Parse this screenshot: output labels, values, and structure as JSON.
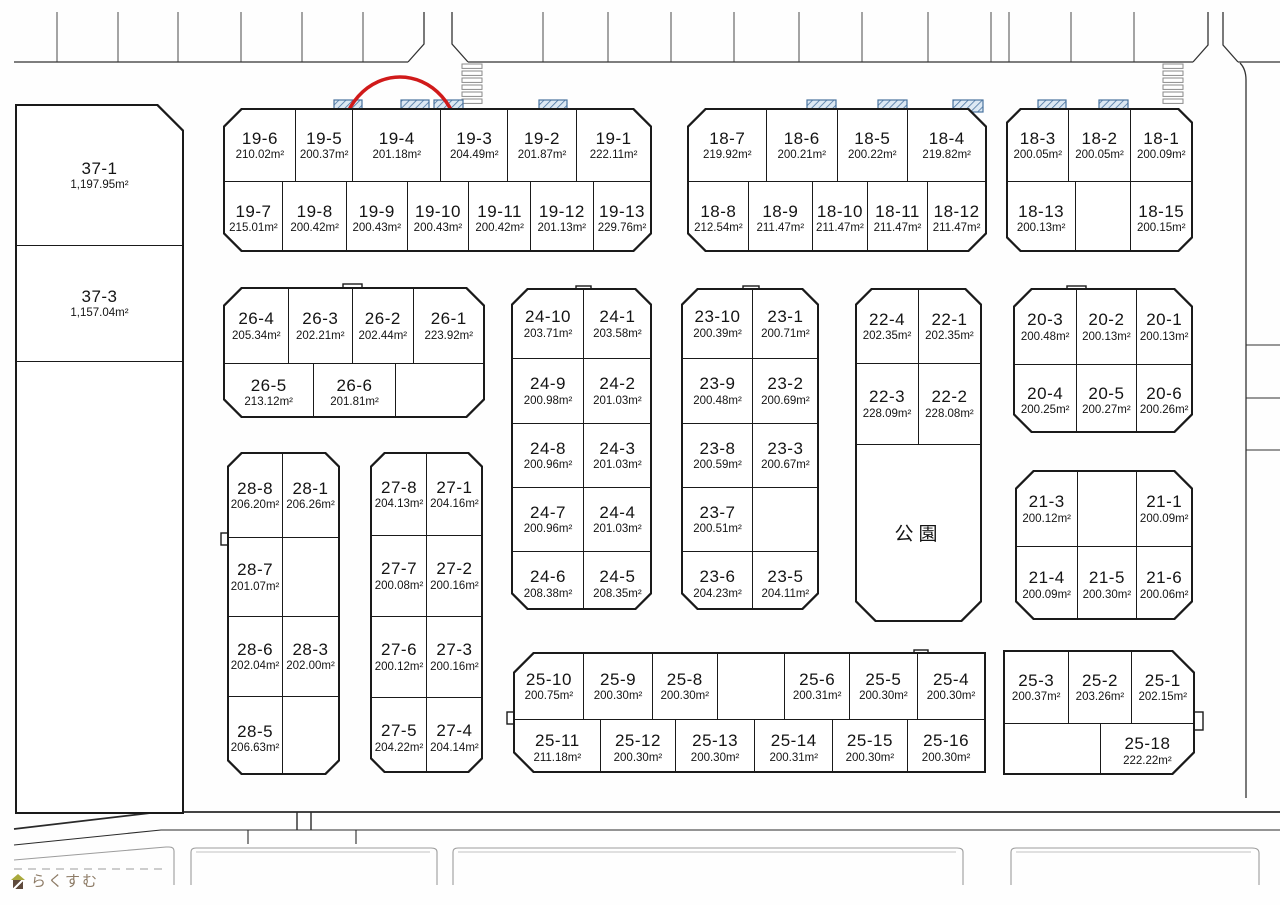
{
  "logo": {
    "text": "らくすむ"
  },
  "highlighted_lot": "19-4",
  "blocks": [
    {
      "id": "b37",
      "rows": [
        [
          {
            "n": "37-1",
            "a": "1,197.95m²"
          }
        ],
        [
          {
            "n": "37-3",
            "a": "1,157.04m²"
          }
        ],
        [
          {}
        ]
      ]
    },
    {
      "id": "b19",
      "rows": [
        [
          {
            "n": "19-6",
            "a": "210.02m²"
          },
          {
            "n": "19-5",
            "a": "200.37m²"
          },
          {
            "n": "19-4",
            "a": "201.18m²"
          },
          {
            "n": "19-3",
            "a": "204.49m²"
          },
          {
            "n": "19-2",
            "a": "201.87m²"
          },
          {
            "n": "19-1",
            "a": "222.11m²"
          }
        ],
        [
          {
            "n": "19-7",
            "a": "215.01m²"
          },
          {
            "n": "19-8",
            "a": "200.42m²"
          },
          {
            "n": "19-9",
            "a": "200.43m²"
          },
          {
            "n": "19-10",
            "a": "200.43m²"
          },
          {
            "n": "19-11",
            "a": "200.42m²"
          },
          {
            "n": "19-12",
            "a": "201.13m²"
          },
          {
            "n": "19-13",
            "a": "229.76m²"
          }
        ]
      ]
    },
    {
      "id": "b18L",
      "rows": [
        [
          {
            "n": "18-7",
            "a": "219.92m²"
          },
          {
            "n": "18-6",
            "a": "200.21m²"
          },
          {
            "n": "18-5",
            "a": "200.22m²"
          },
          {
            "n": "18-4",
            "a": "219.82m²"
          }
        ],
        [
          {
            "n": "18-8",
            "a": "212.54m²"
          },
          {
            "n": "18-9",
            "a": "211.47m²"
          },
          {
            "n": "18-10",
            "a": "211.47m²"
          },
          {
            "n": "18-11",
            "a": "211.47m²"
          },
          {
            "n": "18-12",
            "a": "211.47m²"
          }
        ]
      ]
    },
    {
      "id": "b18R",
      "rows": [
        [
          {
            "n": "18-3",
            "a": "200.05m²"
          },
          {
            "n": "18-2",
            "a": "200.05m²"
          },
          {
            "n": "18-1",
            "a": "200.09m²"
          }
        ],
        [
          {
            "n": "18-13",
            "a": "200.13m²"
          },
          {},
          {
            "n": "18-15",
            "a": "200.15m²"
          }
        ]
      ]
    },
    {
      "id": "b26",
      "rows": [
        [
          {
            "n": "26-4",
            "a": "205.34m²"
          },
          {
            "n": "26-3",
            "a": "202.21m²"
          },
          {
            "n": "26-2",
            "a": "202.44m²"
          },
          {
            "n": "26-1",
            "a": "223.92m²"
          }
        ],
        [
          {
            "n": "26-5",
            "a": "213.12m²"
          },
          {
            "n": "26-6",
            "a": "201.81m²"
          },
          {}
        ]
      ]
    },
    {
      "id": "b24",
      "rows": [
        [
          {
            "n": "24-10",
            "a": "203.71m²"
          },
          {
            "n": "24-1",
            "a": "203.58m²"
          }
        ],
        [
          {
            "n": "24-9",
            "a": "200.98m²"
          },
          {
            "n": "24-2",
            "a": "201.03m²"
          }
        ],
        [
          {
            "n": "24-8",
            "a": "200.96m²"
          },
          {
            "n": "24-3",
            "a": "201.03m²"
          }
        ],
        [
          {
            "n": "24-7",
            "a": "200.96m²"
          },
          {
            "n": "24-4",
            "a": "201.03m²"
          }
        ],
        [
          {
            "n": "24-6",
            "a": "208.38m²"
          },
          {
            "n": "24-5",
            "a": "208.35m²"
          }
        ]
      ]
    },
    {
      "id": "b23",
      "rows": [
        [
          {
            "n": "23-10",
            "a": "200.39m²"
          },
          {
            "n": "23-1",
            "a": "200.71m²"
          }
        ],
        [
          {
            "n": "23-9",
            "a": "200.48m²"
          },
          {
            "n": "23-2",
            "a": "200.69m²"
          }
        ],
        [
          {
            "n": "23-8",
            "a": "200.59m²"
          },
          {
            "n": "23-3",
            "a": "200.67m²"
          }
        ],
        [
          {
            "n": "23-7",
            "a": "200.51m²"
          },
          {}
        ],
        [
          {
            "n": "23-6",
            "a": "204.23m²"
          },
          {
            "n": "23-5",
            "a": "204.11m²"
          }
        ]
      ]
    },
    {
      "id": "b22",
      "rows": [
        [
          {
            "n": "22-4",
            "a": "202.35m²"
          },
          {
            "n": "22-1",
            "a": "202.35m²"
          }
        ],
        [
          {
            "n": "22-3",
            "a": "228.09m²"
          },
          {
            "n": "22-2",
            "a": "228.08m²"
          }
        ],
        [
          {
            "n": "公園",
            "park": true
          }
        ]
      ]
    },
    {
      "id": "b20",
      "rows": [
        [
          {
            "n": "20-3",
            "a": "200.48m²"
          },
          {
            "n": "20-2",
            "a": "200.13m²"
          },
          {
            "n": "20-1",
            "a": "200.13m²"
          }
        ],
        [
          {
            "n": "20-4",
            "a": "200.25m²"
          },
          {
            "n": "20-5",
            "a": "200.27m²"
          },
          {
            "n": "20-6",
            "a": "200.26m²"
          }
        ]
      ]
    },
    {
      "id": "b28",
      "rows": [
        [
          {
            "n": "28-8",
            "a": "206.20m²"
          },
          {
            "n": "28-1",
            "a": "206.26m²"
          }
        ],
        [
          {
            "n": "28-7",
            "a": "201.07m²"
          },
          {}
        ],
        [
          {
            "n": "28-6",
            "a": "202.04m²"
          },
          {
            "n": "28-3",
            "a": "202.00m²"
          }
        ],
        [
          {
            "n": "28-5",
            "a": "206.63m²"
          },
          {}
        ]
      ]
    },
    {
      "id": "b27",
      "rows": [
        [
          {
            "n": "27-8",
            "a": "204.13m²"
          },
          {
            "n": "27-1",
            "a": "204.16m²"
          }
        ],
        [
          {
            "n": "27-7",
            "a": "200.08m²"
          },
          {
            "n": "27-2",
            "a": "200.16m²"
          }
        ],
        [
          {
            "n": "27-6",
            "a": "200.12m²"
          },
          {
            "n": "27-3",
            "a": "200.16m²"
          }
        ],
        [
          {
            "n": "27-5",
            "a": "204.22m²"
          },
          {
            "n": "27-4",
            "a": "204.14m²"
          }
        ]
      ]
    },
    {
      "id": "b21",
      "rows": [
        [
          {
            "n": "21-3",
            "a": "200.12m²"
          },
          {},
          {
            "n": "21-1",
            "a": "200.09m²"
          }
        ],
        [
          {
            "n": "21-4",
            "a": "200.09m²"
          },
          {
            "n": "21-5",
            "a": "200.30m²"
          },
          {
            "n": "21-6",
            "a": "200.06m²"
          }
        ]
      ]
    },
    {
      "id": "b25L",
      "rows": [
        [
          {
            "n": "25-10",
            "a": "200.75m²"
          },
          {
            "n": "25-9",
            "a": "200.30m²"
          },
          {
            "n": "25-8",
            "a": "200.30m²"
          },
          {},
          {
            "n": "25-6",
            "a": "200.31m²"
          },
          {
            "n": "25-5",
            "a": "200.30m²"
          },
          {
            "n": "25-4",
            "a": "200.30m²"
          }
        ],
        [
          {
            "n": "25-11",
            "a": "211.18m²"
          },
          {
            "n": "25-12",
            "a": "200.30m²"
          },
          {
            "n": "25-13",
            "a": "200.30m²"
          },
          {
            "n": "25-14",
            "a": "200.31m²"
          },
          {
            "n": "25-15",
            "a": "200.30m²"
          },
          {
            "n": "25-16",
            "a": "200.30m²"
          }
        ]
      ]
    },
    {
      "id": "b25R",
      "rows": [
        [
          {
            "n": "25-3",
            "a": "200.37m²"
          },
          {
            "n": "25-2",
            "a": "203.26m²"
          },
          {
            "n": "25-1",
            "a": "202.15m²"
          }
        ],
        [
          {},
          {
            "n": "25-18",
            "a": "222.22m²"
          }
        ]
      ]
    }
  ]
}
